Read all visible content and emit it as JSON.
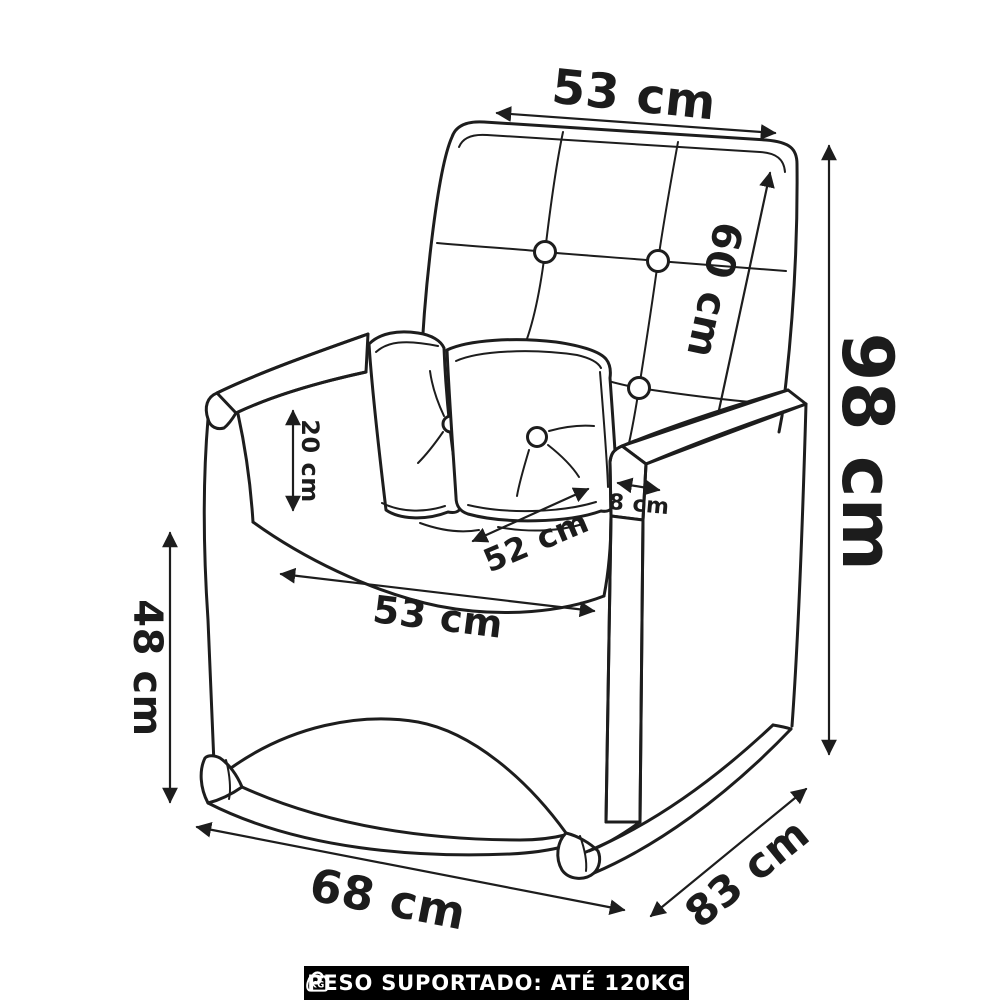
{
  "dimensions": {
    "backrest_width": "53 cm",
    "backrest_height": "60 cm",
    "total_height": "98 cm",
    "armrest_inner_height": "20 cm",
    "armrest_thickness": "8 cm",
    "seat_depth": "52 cm",
    "seat_width": "53 cm",
    "seat_front_height": "48 cm",
    "base_width": "68 cm",
    "total_depth": "83 cm"
  },
  "footer": {
    "text": "PESO SUPORTADO: ATÉ 120KG",
    "icon_label": "KG",
    "background": "#000000",
    "text_color": "#ffffff"
  },
  "style": {
    "line_color": "#1d1d1d",
    "background": "#ffffff"
  }
}
